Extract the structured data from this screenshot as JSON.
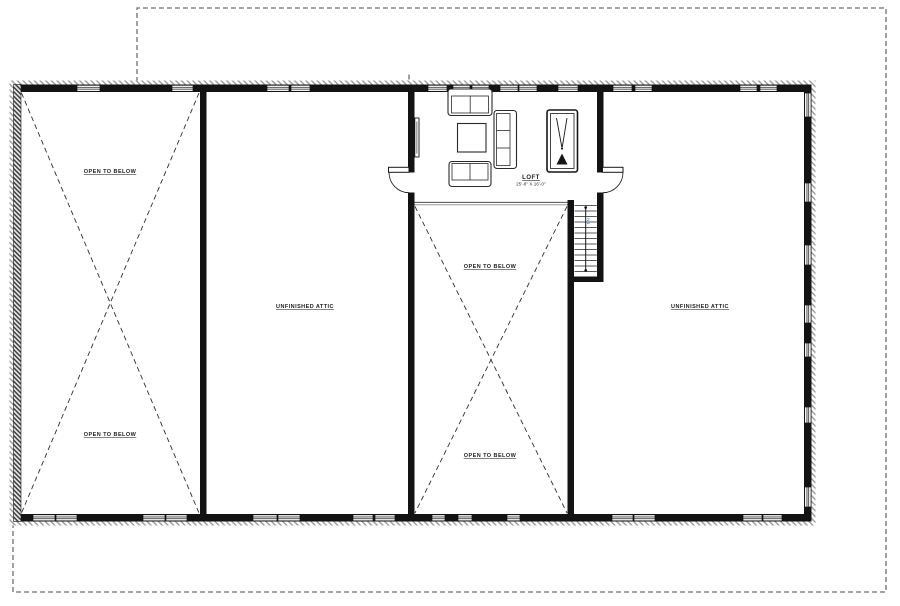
{
  "plan": {
    "labels": {
      "open_to_below": "OPEN TO BELOW",
      "unfinished_attic": "UNFINISHED ATTIC"
    },
    "loft": {
      "name": "LOFT",
      "dimensions": "25'-8\" X 16'-0\""
    },
    "stairs": {
      "direction_label": "DN"
    },
    "colors": {
      "paper": "#ffffff",
      "wall": "#131313",
      "linework": "#222222",
      "furniture_line": "#2a2a2a",
      "xline": "#2e2e2e",
      "dashed_outline": "#6e6e6e",
      "railing": "#8a8a8a",
      "stair_label_blue": "#5b8bd4"
    }
  }
}
